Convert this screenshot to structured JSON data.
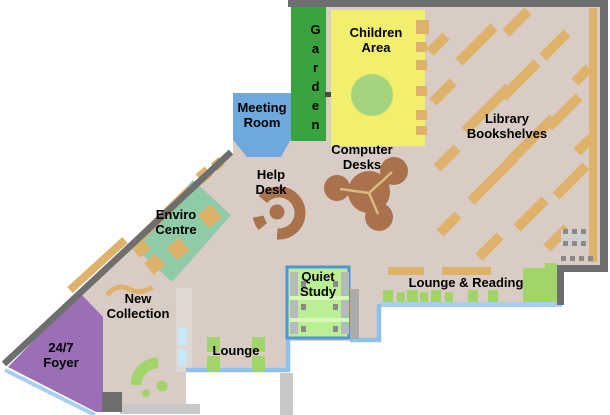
{
  "map": {
    "rooms": {
      "garden": {
        "label": "Garden"
      },
      "children_area": {
        "label": "Children Area"
      },
      "library_bookshelves": {
        "label": "Library Bookshelves"
      },
      "meeting_room": {
        "label": "Meeting Room"
      },
      "computer_desks": {
        "label": "Computer Desks"
      },
      "help_desk": {
        "label": "Help Desk"
      },
      "enviro_centre": {
        "label": "Enviro Centre"
      },
      "new_collection": {
        "label": "New Collection"
      },
      "quiet_study": {
        "label": "Quiet Study"
      },
      "lounge_reading": {
        "label": "Lounge & Reading"
      },
      "lounge": {
        "label": "Lounge"
      },
      "foyer": {
        "label": "24/7 Foyer"
      }
    },
    "colors": {
      "floor": "#D8CCC5",
      "wall": "#6E6E6E",
      "garden_green": "#3AA23E",
      "children_yellow": "#F3EF6E",
      "shelf_tan": "#DFB26C",
      "meeting_blue": "#6FA8DC",
      "enviro_green": "#8FCBA6",
      "desk_brown": "#A9714C",
      "foyer_purple": "#9B6FB5",
      "study_green": "#BCEF93",
      "study_border_blue": "#4D96D8",
      "sofa_green": "#A2D46C",
      "window_blue": "#A9CFF0"
    }
  }
}
